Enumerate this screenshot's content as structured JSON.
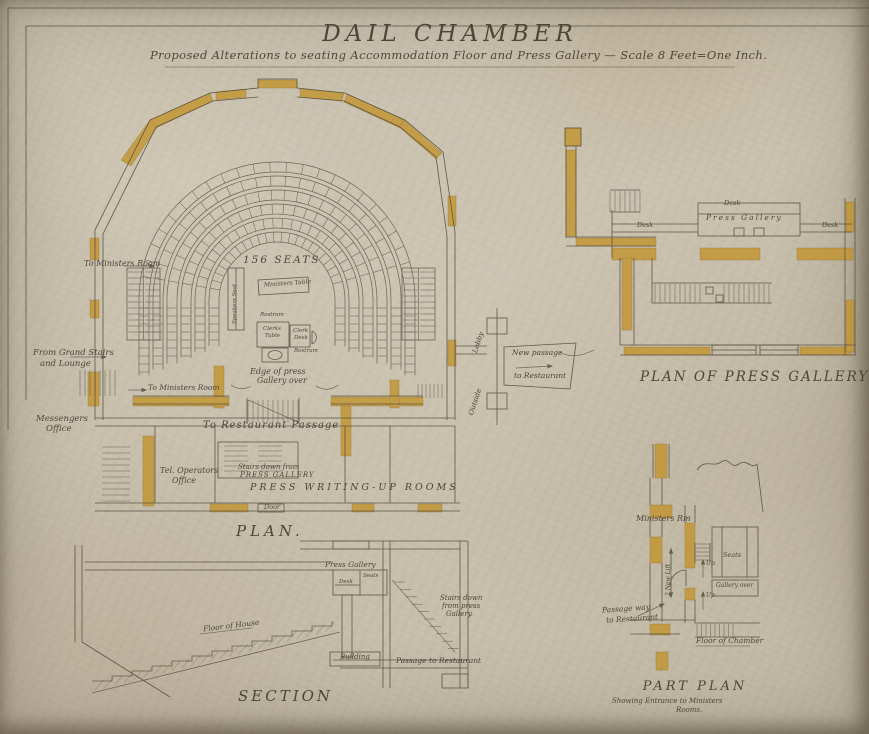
{
  "colors": {
    "paper": "#ccc4b2",
    "ink": "#4e4739",
    "ochre": "#c3942e"
  },
  "sheet": {
    "title": "DAIL CHAMBER",
    "subtitle": "Proposed Alterations to seating Accommodation Floor and Press Gallery — Scale 8 Feet=One Inch."
  },
  "plan": {
    "title": "PLAN.",
    "seats_count": "156 SEATS",
    "to_ministers_room_top": "To Ministers Room",
    "from_grand_stairs_1": "From Grand Stairs",
    "from_grand_stairs_2": "and Lounge",
    "messengers_office_1": "Messengers",
    "messengers_office_2": "Office",
    "to_ministers_room_2": "To Ministers Room",
    "edge_of_press_1": "Edge of press",
    "edge_of_press_2": "Gallery over",
    "to_restaurant_passage": "To Restaurant Passage",
    "stairs_down_1": "Stairs down from",
    "stairs_down_2": "PRESS GALLERY",
    "tel_office_1": "Tel. Operators",
    "tel_office_2": "Office",
    "press_writing_rooms": "PRESS WRITING-UP ROOMS",
    "door": "Door",
    "speakers_seat": "Speakers Seat",
    "ministers_table": "Ministers Table",
    "rostrum_top": "Rostrum",
    "clerks_table_1": "Clerks",
    "clerks_table_2": "Table",
    "clerks_desk_1": "Clerk",
    "clerks_desk_2": "Desk",
    "rostrum_bottom": "Rostrum"
  },
  "connector": {
    "lobby": "Lobby",
    "new_passage_1": "New passage",
    "new_passage_2": "to Restaurant",
    "outside": "Outside"
  },
  "press_gallery_plan": {
    "title": "PLAN OF PRESS GALLERY",
    "desk_top": "Desk",
    "press_gallery": "Press Gallery",
    "desk_left": "Desk",
    "desk_right": "Desk"
  },
  "section": {
    "title": "SECTION",
    "press_gallery": "Press Gallery",
    "desk": "Desk",
    "seats": "Seats",
    "stairs_down_1": "Stairs down",
    "stairs_down_2": "from press",
    "stairs_down_3": "Gallery.",
    "floor_of_house": "Floor of House",
    "building": "Building",
    "passage_to_restaurant": "Passage to Restaurant"
  },
  "part_plan": {
    "title": "PART PLAN",
    "subtitle_1": "Showing Entrance to Ministers",
    "subtitle_2": "Rooms.",
    "ministers_rm": "Ministers Rm",
    "seats": "Seats",
    "gallery_over": "Gallery over",
    "new_lift": "2 New Lift",
    "up_1": "Up",
    "up_2": "Up",
    "passage_way_1": "Passage way",
    "passage_way_2": "to Restaurant",
    "floor_of_chamber": "Floor of Chamber"
  }
}
